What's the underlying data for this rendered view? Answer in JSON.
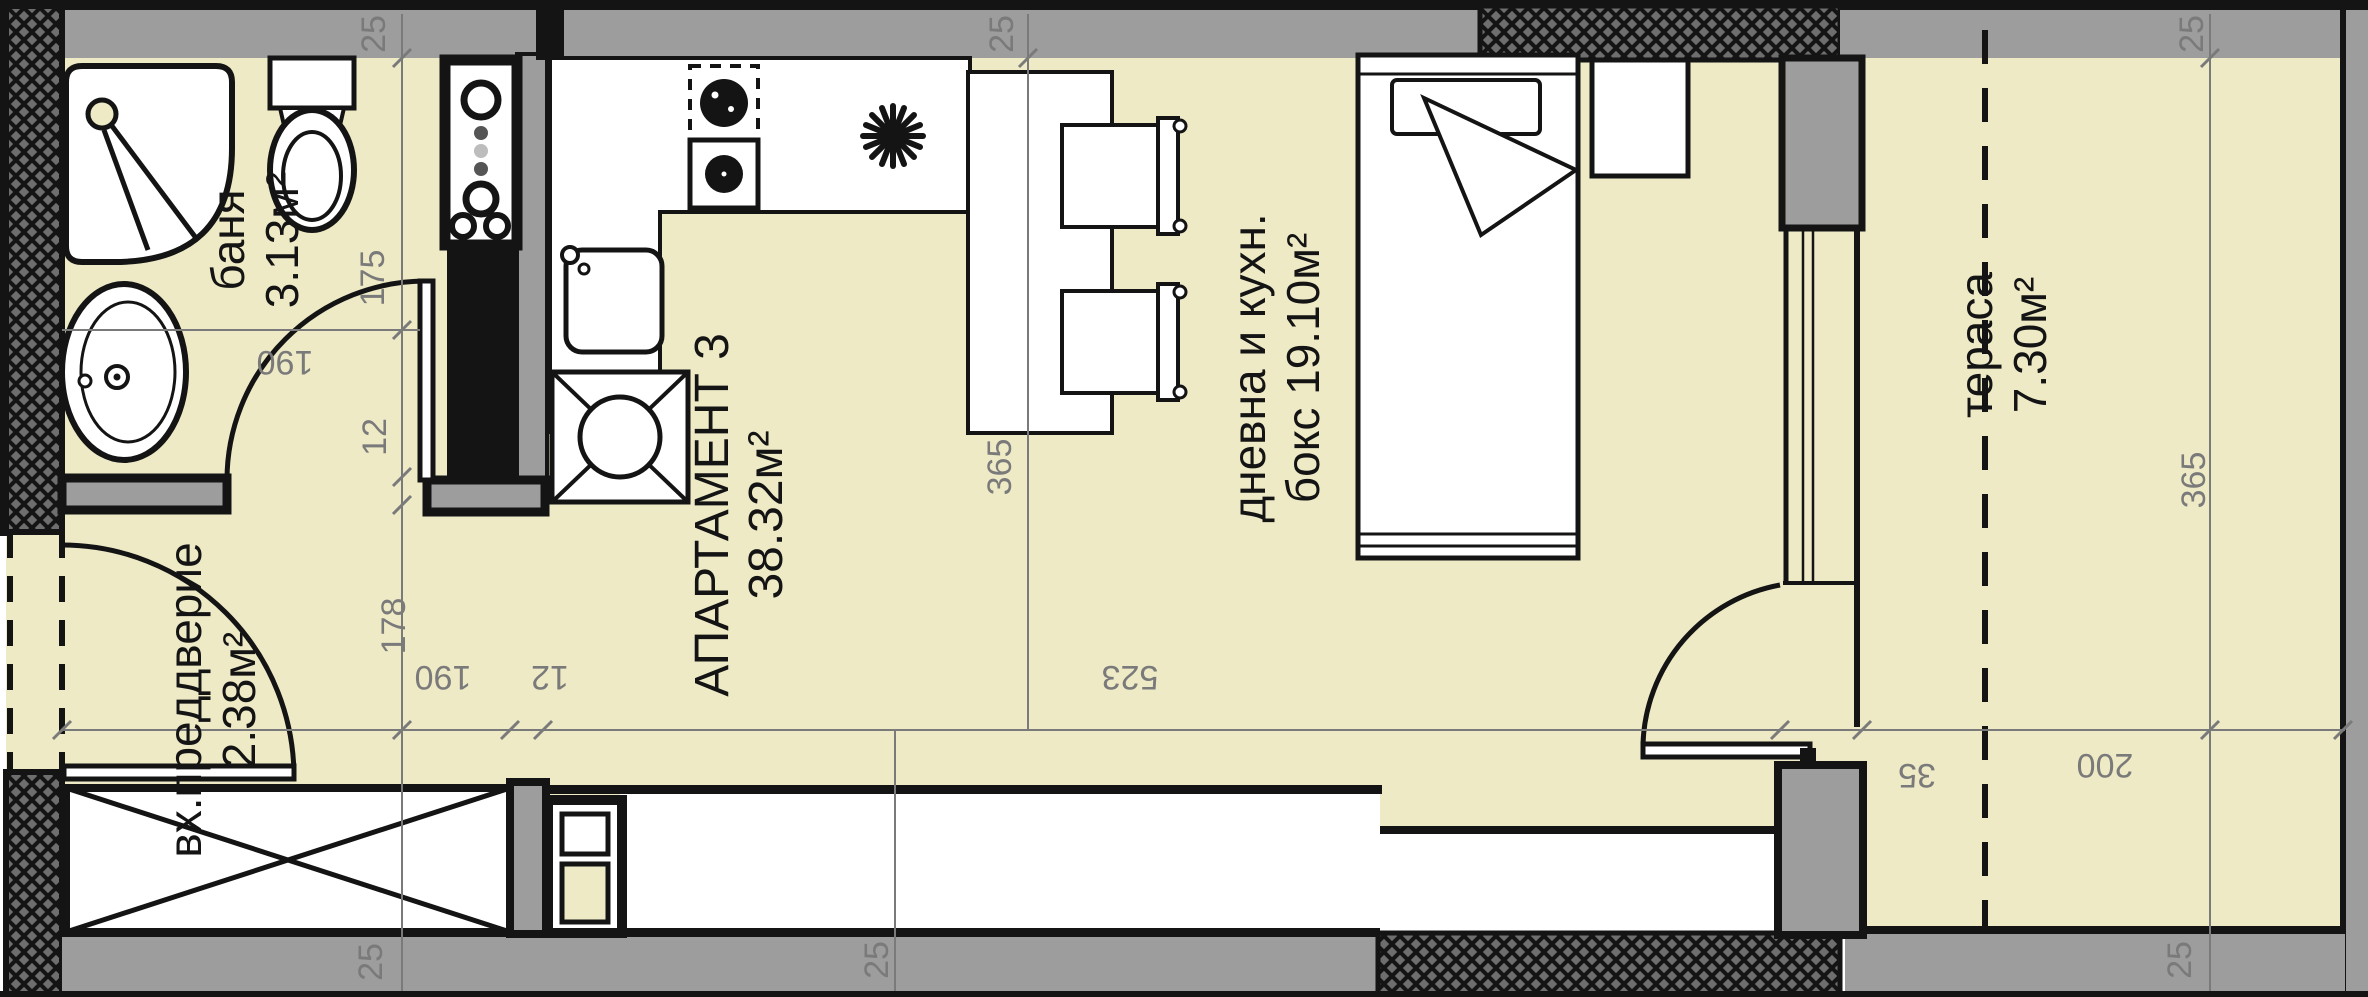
{
  "meta": {
    "kind": "architectural-floor-plan"
  },
  "colors": {
    "floor": "#eeeac6",
    "wall_gray": "#9d9d9d",
    "outline": "#141414",
    "dim_gray": "#7a7a7a"
  },
  "apartment": {
    "name": "АПАРТАМЕНТ 3",
    "area": "38.32м²"
  },
  "rooms": [
    {
      "id": "bathroom",
      "name": "баня",
      "area": "3.13м²"
    },
    {
      "id": "entry-hall",
      "name": "вх.преддверие",
      "area": "2.38м²"
    },
    {
      "id": "living-kitchen",
      "name": "дневна и кухн.",
      "area": "бокс 19.10м²"
    },
    {
      "id": "terrace",
      "name": "тераса",
      "area": "7.30м²"
    }
  ],
  "dims": {
    "top_left": "25",
    "top_mid": "25",
    "top_right": "25",
    "v_175": "175",
    "v_12": "12",
    "v_178": "178",
    "bath_190": "190",
    "h_190": "190",
    "h_12": "12",
    "h_523": "523",
    "h_35": "35",
    "h_200": "200",
    "living_365": "365",
    "terrace_365": "365",
    "bottom_left": "25",
    "bottom_mid": "25",
    "bottom_right": "25"
  },
  "fixtures": [
    "shower",
    "toilet",
    "washbasin",
    "vent-shaft",
    "kitchen-counter",
    "cooktop",
    "extractor-star",
    "kitchen-sink",
    "washing-machine",
    "dining-table",
    "chair",
    "bed",
    "nightstand",
    "wardrobe",
    "radiator",
    "entry-door",
    "bathroom-door",
    "terrace-door",
    "window"
  ]
}
